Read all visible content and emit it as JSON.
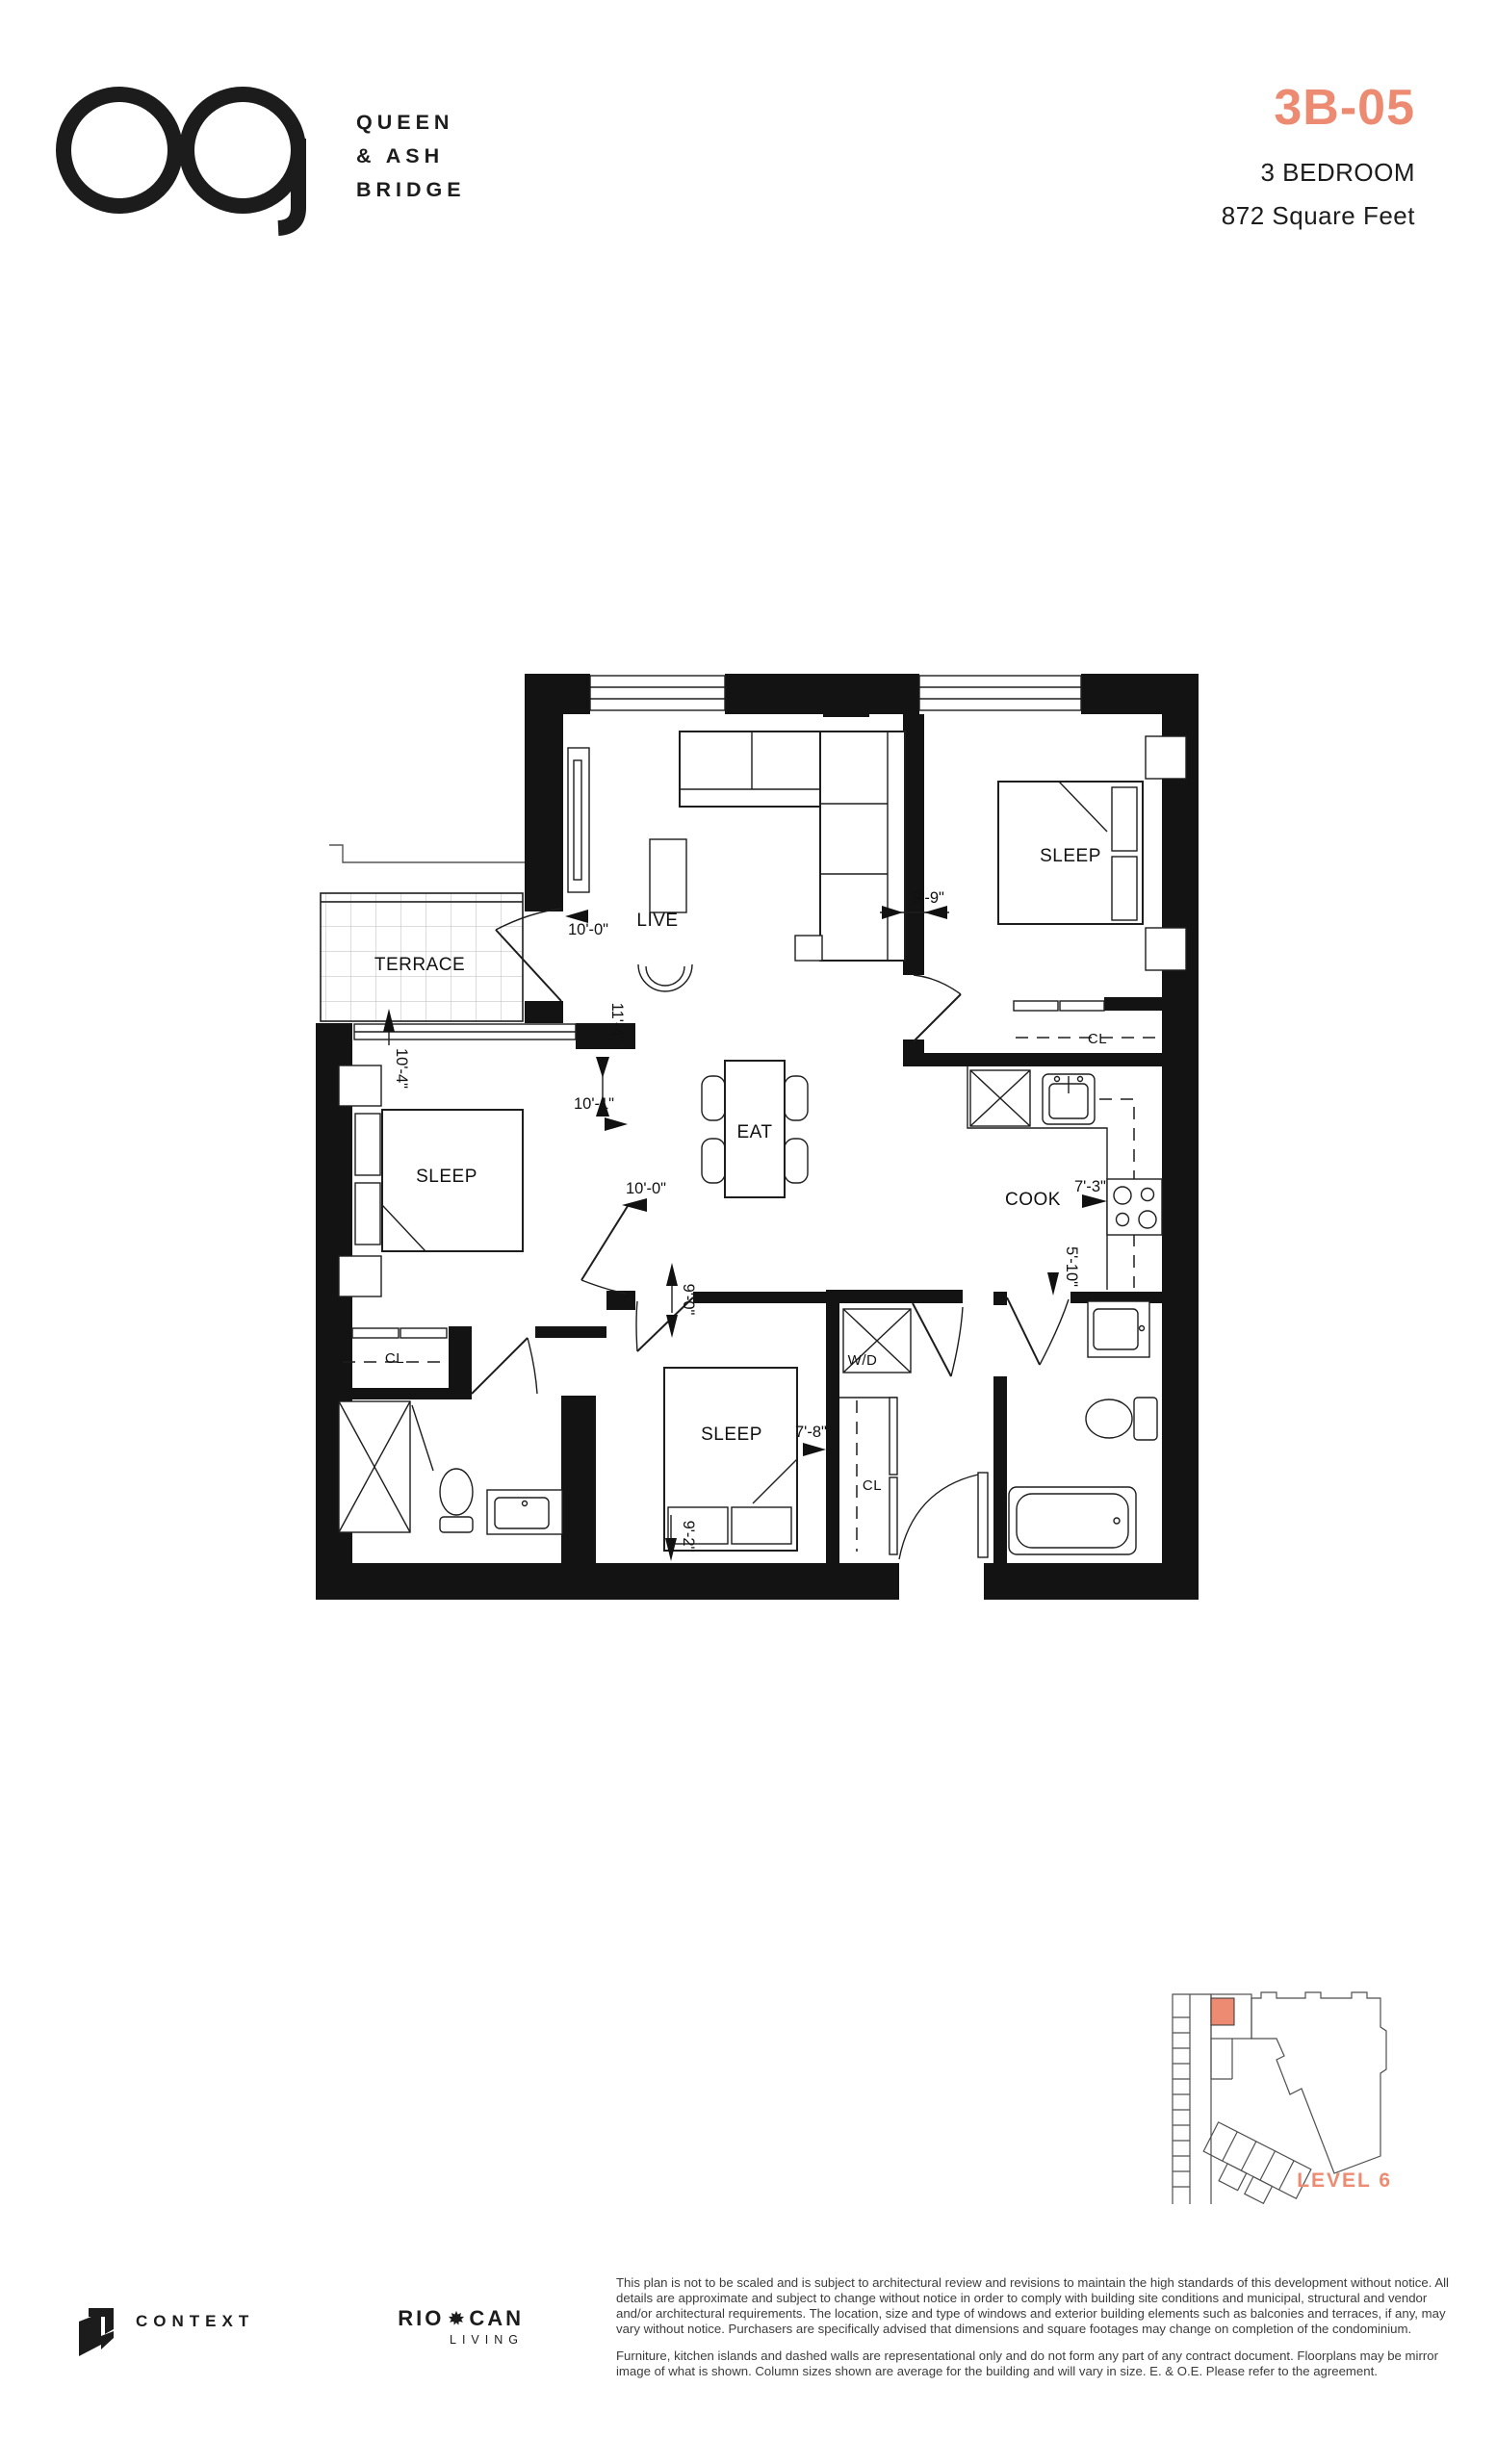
{
  "accent_color": "#ED8B72",
  "brand": {
    "line1": "QUEEN",
    "line2": "& ASH",
    "line3": "BRIDGE"
  },
  "unit": {
    "code": "3B-05",
    "type": "3 BEDROOM",
    "area": "872 Square Feet"
  },
  "floorplan": {
    "rooms": {
      "terrace": "TERRACE",
      "live": "LIVE",
      "eat": "EAT",
      "cook": "COOK",
      "sleep": "SLEEP",
      "laundry": "W/D",
      "closet": "CL"
    },
    "dims": {
      "live_w": "10'-0\"",
      "sleep2_w": "9'-9\"",
      "live_d": "11'-4\"",
      "sleep1_d": "10'-4\"",
      "sleep1_w": "10'-1\"",
      "sleep1_w2": "10'-0\"",
      "hall_d": "9'-0\"",
      "cook_w": "7'-3\"",
      "cook_d": "5'-10\"",
      "sleep3_w": "7'-8\"",
      "sleep3_d": "9'-2\""
    }
  },
  "keyplan": {
    "level": "LEVEL 6"
  },
  "footer": {
    "developer": "CONTEXT",
    "partner_a": "RIO",
    "partner_b": "CAN",
    "partner_sub": "LIVING",
    "disclaimer_p1": "This plan is not to be scaled and is subject to architectural review and revisions to maintain the high standards of this development without notice. All details are approximate and subject to change without notice in order to comply with building site conditions and municipal, structural and vendor and/or architectural requirements. The location, size and type of windows and exterior building elements such as balconies and terraces, if any, may vary without notice. Purchasers are specifically advised that dimensions and square footages may change on completion of the condominium.",
    "disclaimer_p2": "Furniture, kitchen islands and dashed walls are representational only and do not form any part of any contract document. Floorplans may be mirror image of what is shown. Column sizes shown are average for the building and will vary in size. E. & O.E. Please refer to the agreement."
  }
}
